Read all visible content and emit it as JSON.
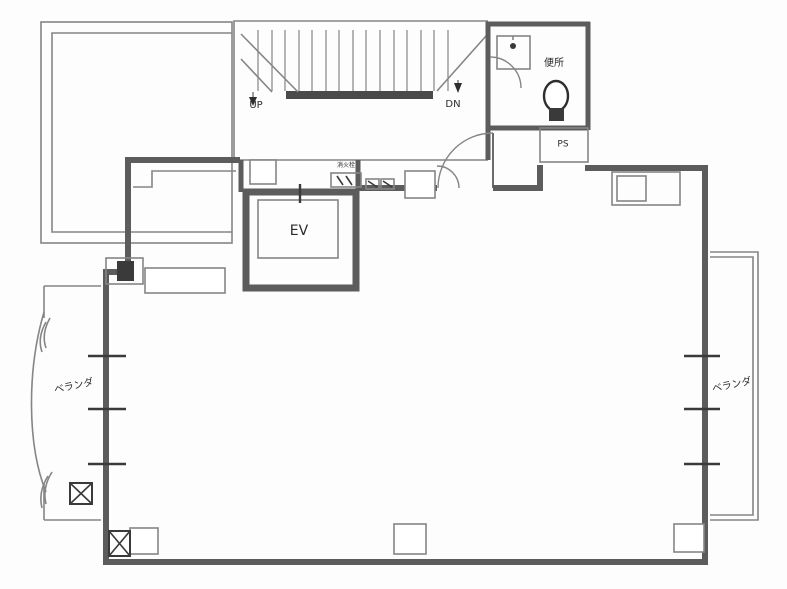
{
  "title": "building-floor-plan",
  "colors": {
    "wall": "#5c5c5c",
    "thin": "#858585",
    "dark": "#3a3a3a",
    "ink": "#2b2b2b",
    "bg": "#fdfdfd"
  },
  "labels": {
    "stairs_up": "UP",
    "stairs_down": "DN",
    "elevator": "EV",
    "toilet": "便所",
    "pipe_space": "PS",
    "hydrant": "消火栓",
    "veranda_left": "ベランダ",
    "veranda_right": "ベランダ"
  }
}
